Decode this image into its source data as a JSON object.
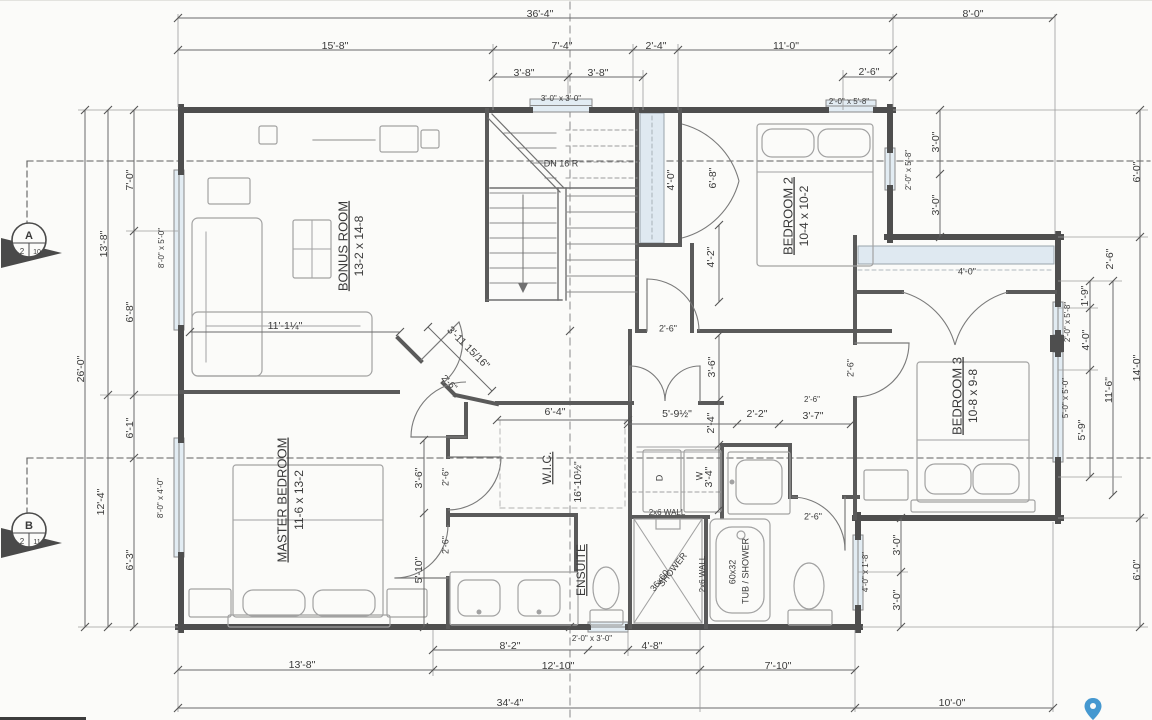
{
  "drawing_type": "floor-plan",
  "colors": {
    "wall": "#4e4e4e",
    "interior_wall": "#5a5a5a",
    "thin_line": "#6a6a6a",
    "dashed_section": "#5f5f5f",
    "window_fill": "#e2ecf3",
    "closet_fill": "#dfe9f1",
    "furniture": "#a2a2a2",
    "text": "#3a3a3a",
    "map_pin": "#4598d0"
  },
  "rooms": [
    {
      "name": "BONUS ROOM",
      "size": "13-2 x 14-8"
    },
    {
      "name": "BEDROOM 2",
      "size": "10-4 x 10-2"
    },
    {
      "name": "BEDROOM 3",
      "size": "10-8 x 9-8"
    },
    {
      "name": "MASTER BEDROOM",
      "size": "11-6 x 13-2"
    },
    {
      "name": "W.I.C.",
      "size": ""
    },
    {
      "name": "ENSUITE",
      "size": ""
    }
  ],
  "stairs_note": "DN 16 R",
  "markers": {
    "section_a": {
      "letter": "A",
      "num": "2",
      "sheet": "10"
    },
    "section_b": {
      "letter": "B",
      "num": "2",
      "sheet": "11"
    }
  },
  "labels": [
    {
      "t": "36'-4\"",
      "x": 540,
      "y": 14
    },
    {
      "t": "8'-0\"",
      "x": 973,
      "y": 14
    },
    {
      "t": "15'-8\"",
      "x": 335,
      "y": 46
    },
    {
      "t": "7'-4\"",
      "x": 562,
      "y": 46
    },
    {
      "t": "2'-4\"",
      "x": 656,
      "y": 46
    },
    {
      "t": "11'-0\"",
      "x": 786,
      "y": 46
    },
    {
      "t": "3'-8\"",
      "x": 524,
      "y": 73
    },
    {
      "t": "3'-8\"",
      "x": 598,
      "y": 73
    },
    {
      "t": "2'-6\"",
      "x": 869,
      "y": 72
    },
    {
      "t": "3'-0\" x 3'-0\"",
      "x": 561,
      "y": 99,
      "s": 8
    },
    {
      "t": "2'-0\" x 5'-8\"",
      "x": 849,
      "y": 102,
      "s": 8
    },
    {
      "t": "26'-0\"",
      "x": 81,
      "y": 369,
      "r": -90
    },
    {
      "t": "13'-8\"",
      "x": 104,
      "y": 244,
      "r": -90
    },
    {
      "t": "7'-0\"",
      "x": 130,
      "y": 180,
      "r": -90
    },
    {
      "t": "6'-8\"",
      "x": 130,
      "y": 312,
      "r": -90
    },
    {
      "t": "8'-0\" x 5'-0\"",
      "x": 162,
      "y": 248,
      "r": -90,
      "s": 8
    },
    {
      "t": "12'-4\"",
      "x": 101,
      "y": 502,
      "r": -90
    },
    {
      "t": "6'-1\"",
      "x": 130,
      "y": 428,
      "r": -90
    },
    {
      "t": "6'-3\"",
      "x": 130,
      "y": 560,
      "r": -90
    },
    {
      "t": "8'-0\" x 4'-0\"",
      "x": 161,
      "y": 498,
      "r": -90,
      "s": 8
    },
    {
      "t": "3'-0\"",
      "x": 936,
      "y": 142,
      "r": -90
    },
    {
      "t": "2'-0\" x 5'-8\"",
      "x": 909,
      "y": 170,
      "r": -90,
      "s": 8
    },
    {
      "t": "3'-0\"",
      "x": 936,
      "y": 205,
      "r": -90
    },
    {
      "t": "6'-0\"",
      "x": 1137,
      "y": 172,
      "r": -90
    },
    {
      "t": "2'-6\"",
      "x": 1110,
      "y": 259,
      "r": -90
    },
    {
      "t": "1'-9\"",
      "x": 1085,
      "y": 296,
      "r": -90
    },
    {
      "t": "2'-0\" x 5'-8\"",
      "x": 1068,
      "y": 322,
      "r": -90,
      "s": 8
    },
    {
      "t": "4'-0\"",
      "x": 1086,
      "y": 340,
      "r": -90
    },
    {
      "t": "5'-0\" x 5'-0\"",
      "x": 1066,
      "y": 398,
      "r": -90,
      "s": 8
    },
    {
      "t": "11'-6\"",
      "x": 1109,
      "y": 390,
      "r": -90
    },
    {
      "t": "14'-0\"",
      "x": 1137,
      "y": 368,
      "r": -90
    },
    {
      "t": "5'-9\"",
      "x": 1082,
      "y": 430,
      "r": -90
    },
    {
      "t": "6'-0\"",
      "x": 1137,
      "y": 570,
      "r": -90
    },
    {
      "t": "3'-0\"",
      "x": 897,
      "y": 545,
      "r": -90
    },
    {
      "t": "4'-0\" x 1'-8\"",
      "x": 866,
      "y": 572,
      "r": -90,
      "s": 8
    },
    {
      "t": "3'-0\"",
      "x": 897,
      "y": 600,
      "r": -90
    },
    {
      "t": "13'-8\"",
      "x": 302,
      "y": 665
    },
    {
      "t": "8'-2\"",
      "x": 510,
      "y": 646
    },
    {
      "t": "2'-0\" x 3'-0\"",
      "x": 592,
      "y": 639,
      "s": 8
    },
    {
      "t": "4'-8\"",
      "x": 652,
      "y": 646
    },
    {
      "t": "12'-10\"",
      "x": 558,
      "y": 666
    },
    {
      "t": "7'-10\"",
      "x": 778,
      "y": 666
    },
    {
      "t": "34'-4\"",
      "x": 510,
      "y": 703
    },
    {
      "t": "10'-0\"",
      "x": 952,
      "y": 703
    },
    {
      "t": "BONUS ROOM",
      "x": 344,
      "y": 246,
      "r": -90,
      "s": 13,
      "u": true
    },
    {
      "t": "13-2 x 14-8",
      "x": 360,
      "y": 246,
      "r": -90,
      "s": 12
    },
    {
      "t": "BEDROOM 2",
      "x": 789,
      "y": 216,
      "r": -90,
      "s": 13,
      "u": true
    },
    {
      "t": "10-4 x 10-2",
      "x": 805,
      "y": 216,
      "r": -90,
      "s": 12
    },
    {
      "t": "BEDROOM 3",
      "x": 958,
      "y": 396,
      "r": -90,
      "s": 13,
      "u": true
    },
    {
      "t": "10-8 x 9-8",
      "x": 974,
      "y": 396,
      "r": -90,
      "s": 12
    },
    {
      "t": "MASTER BEDROOM",
      "x": 283,
      "y": 500,
      "r": -90,
      "s": 13,
      "u": true
    },
    {
      "t": "11-6 x 13-2",
      "x": 300,
      "y": 500,
      "r": -90,
      "s": 12
    },
    {
      "t": "W.I.C.",
      "x": 548,
      "y": 468,
      "r": -90,
      "s": 12,
      "u": true
    },
    {
      "t": "ENSUITE",
      "x": 582,
      "y": 570,
      "r": -90,
      "s": 12,
      "u": true
    },
    {
      "t": "DN 16 R",
      "x": 561,
      "y": 164,
      "s": 9
    },
    {
      "t": "11'-1¼\"",
      "x": 285,
      "y": 326
    },
    {
      "t": "3'-11 15/16\"",
      "x": 468,
      "y": 348,
      "r": 45
    },
    {
      "t": "2'-6\"",
      "x": 449,
      "y": 383,
      "r": 45,
      "s": 9
    },
    {
      "t": "2'-6\"",
      "x": 446,
      "y": 477,
      "r": -90,
      "s": 9
    },
    {
      "t": "2'-6\"",
      "x": 446,
      "y": 545,
      "r": -90,
      "s": 9
    },
    {
      "t": "16'-10½\"",
      "x": 578,
      "y": 482,
      "r": -90
    },
    {
      "t": "6'-4\"",
      "x": 555,
      "y": 412
    },
    {
      "t": "5'-9½\"",
      "x": 677,
      "y": 414
    },
    {
      "t": "2'-2\"",
      "x": 757,
      "y": 414
    },
    {
      "t": "3'-7\"",
      "x": 813,
      "y": 416
    },
    {
      "t": "2'-6\"",
      "x": 812,
      "y": 400,
      "s": 8
    },
    {
      "t": "3'-6\"",
      "x": 712,
      "y": 367,
      "r": -90
    },
    {
      "t": "2'-4\"",
      "x": 711,
      "y": 423,
      "r": -90
    },
    {
      "t": "3'-4\"",
      "x": 709,
      "y": 477,
      "r": -90
    },
    {
      "t": "D",
      "x": 660,
      "y": 478,
      "r": -90,
      "s": 9
    },
    {
      "t": "W",
      "x": 700,
      "y": 476,
      "r": -90,
      "s": 9
    },
    {
      "t": "2x6 WALL",
      "x": 667,
      "y": 513,
      "s": 8
    },
    {
      "t": "2x6 WALL",
      "x": 703,
      "y": 574,
      "r": -90,
      "s": 8
    },
    {
      "t": "36x60",
      "x": 660,
      "y": 581,
      "r": -52,
      "s": 9
    },
    {
      "t": "SHOWER",
      "x": 673,
      "y": 570,
      "r": -52,
      "s": 9
    },
    {
      "t": "60x32",
      "x": 733,
      "y": 572,
      "r": -90,
      "s": 9
    },
    {
      "t": "TUB / SHOWER",
      "x": 746,
      "y": 571,
      "r": -90,
      "s": 9
    },
    {
      "t": "4'-2\"",
      "x": 711,
      "y": 257,
      "r": -90
    },
    {
      "t": "6'-8\"",
      "x": 713,
      "y": 178,
      "r": -90
    },
    {
      "t": "4'-0\"",
      "x": 671,
      "y": 180,
      "r": -90
    },
    {
      "t": "2'-6\"",
      "x": 668,
      "y": 329,
      "s": 9
    },
    {
      "t": "2'-6\"",
      "x": 851,
      "y": 368,
      "r": -90,
      "s": 9
    },
    {
      "t": "2'-6\"",
      "x": 813,
      "y": 517,
      "s": 9
    },
    {
      "t": "4'-0\"",
      "x": 967,
      "y": 272,
      "s": 9
    },
    {
      "t": "3'-6\"",
      "x": 419,
      "y": 478,
      "r": -90
    },
    {
      "t": "5'-10\"",
      "x": 419,
      "y": 570,
      "r": -90
    }
  ]
}
